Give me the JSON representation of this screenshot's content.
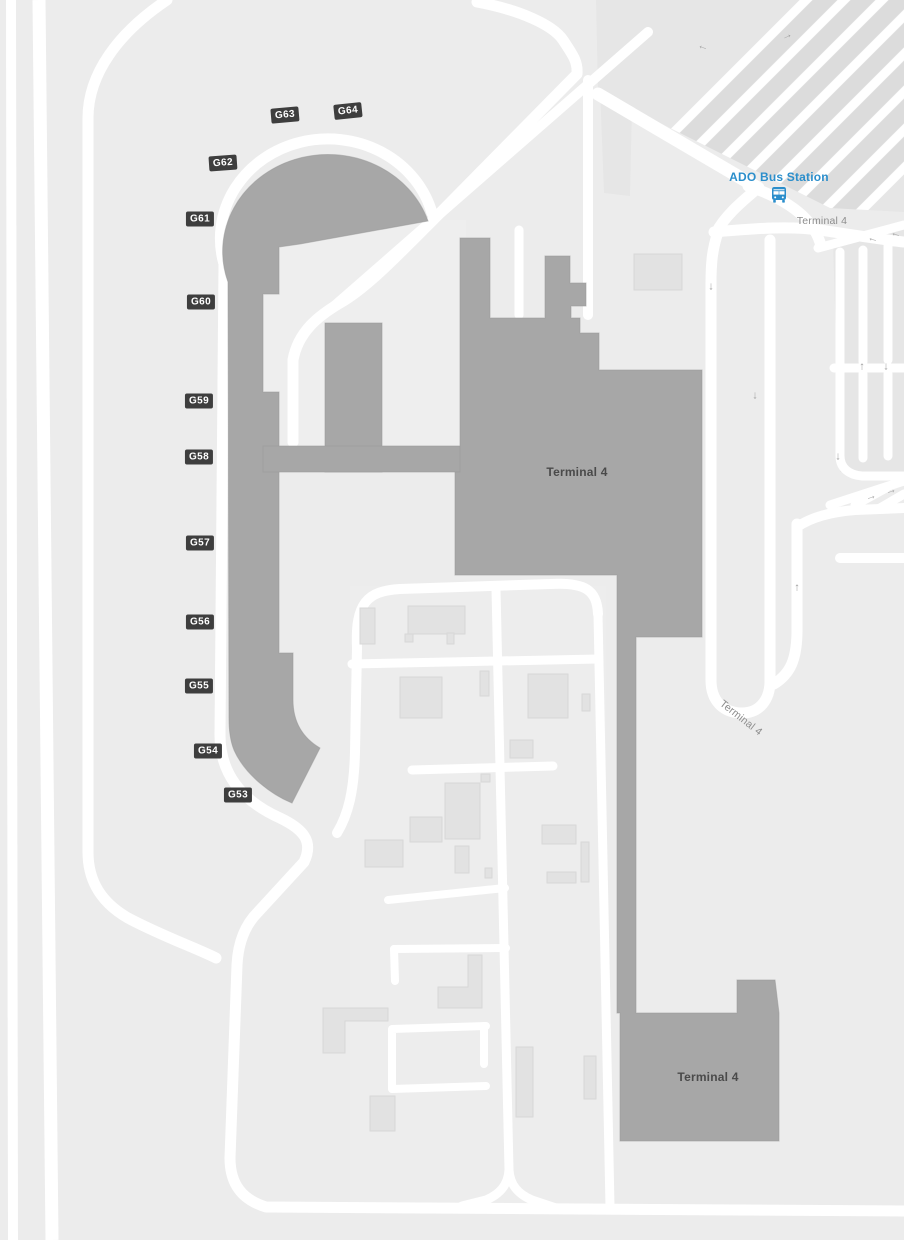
{
  "map_title": "Terminal 4 airport map",
  "colors": {
    "bg": "#ececec",
    "road": "#ffffff",
    "terminal": "#a7a7a7",
    "terminal_edge": "#999999",
    "building": "#e2e2e2",
    "building_edge": "#d7d7d7",
    "badge_bg": "#3e3e3e",
    "badge_text": "#ffffff",
    "blue": "#2b8ecb",
    "label_dark": "#4a4a4a",
    "label_gray": "#8d8d8d",
    "arrow": "#a2a2a2",
    "lane": "#dcdcdc",
    "parking_base": "#e6e6e6",
    "apron": "#f0f0f0"
  },
  "labels": [
    {
      "name": "terminal-label-main",
      "text": "Terminal 4",
      "x": 577,
      "y": 472,
      "rot": 0,
      "cls": "",
      "interactable": false
    },
    {
      "name": "terminal-label-south",
      "text": "Terminal 4",
      "x": 708,
      "y": 1077,
      "rot": 0,
      "cls": "",
      "interactable": false
    },
    {
      "name": "road-label-terminal4-top",
      "text": "Terminal 4",
      "x": 822,
      "y": 221,
      "rot": 0,
      "cls": "roadlbl",
      "interactable": false
    },
    {
      "name": "road-label-terminal4-curve",
      "text": "Terminal 4",
      "x": 741,
      "y": 718,
      "rot": 38,
      "cls": "roadlbl",
      "interactable": false
    },
    {
      "name": "ado-bus-station-label",
      "text": "ADO Bus Station",
      "x": 779,
      "y": 177,
      "rot": 0,
      "cls": "blue",
      "interactable": true
    }
  ],
  "gates": [
    {
      "label": "G64",
      "x": 348,
      "y": 111,
      "rot": -6
    },
    {
      "label": "G63",
      "x": 285,
      "y": 115,
      "rot": -5
    },
    {
      "label": "G62",
      "x": 223,
      "y": 163,
      "rot": -4
    },
    {
      "label": "G61",
      "x": 200,
      "y": 219,
      "rot": 0
    },
    {
      "label": "G60",
      "x": 201,
      "y": 302,
      "rot": 0
    },
    {
      "label": "G59",
      "x": 199,
      "y": 401,
      "rot": 0
    },
    {
      "label": "G58",
      "x": 199,
      "y": 457,
      "rot": 0
    },
    {
      "label": "G57",
      "x": 200,
      "y": 543,
      "rot": 0
    },
    {
      "label": "G56",
      "x": 200,
      "y": 622,
      "rot": 0
    },
    {
      "label": "G55",
      "x": 199,
      "y": 686,
      "rot": 0
    },
    {
      "label": "G54",
      "x": 208,
      "y": 751,
      "rot": 0
    },
    {
      "label": "G53",
      "x": 238,
      "y": 795,
      "rot": 0
    }
  ],
  "arrows": [
    {
      "name": "left-arrow",
      "glyph": "←",
      "x": 703,
      "y": 47,
      "rot": 18
    },
    {
      "name": "up-right-arrow",
      "glyph": "→",
      "x": 787,
      "y": 36,
      "rot": -25
    },
    {
      "name": "down-arrow",
      "glyph": "↓",
      "x": 711,
      "y": 287,
      "rot": 0
    },
    {
      "name": "down-arrow",
      "glyph": "↓",
      "x": 755,
      "y": 396,
      "rot": 0
    },
    {
      "name": "up-arrow",
      "glyph": "↑",
      "x": 862,
      "y": 367,
      "rot": 0
    },
    {
      "name": "down-arrow",
      "glyph": "↓",
      "x": 886,
      "y": 367,
      "rot": 0
    },
    {
      "name": "down-arrow",
      "glyph": "↓",
      "x": 838,
      "y": 457,
      "rot": 0
    },
    {
      "name": "up-arrow",
      "glyph": "↑",
      "x": 797,
      "y": 588,
      "rot": 0
    },
    {
      "name": "left-arrow",
      "glyph": "←",
      "x": 873,
      "y": 239,
      "rot": 15
    },
    {
      "name": "left-arrow",
      "glyph": "←",
      "x": 896,
      "y": 234,
      "rot": 15
    },
    {
      "name": "right-arrow",
      "glyph": "→",
      "x": 871,
      "y": 497,
      "rot": -16
    },
    {
      "name": "right-arrow",
      "glyph": "→",
      "x": 891,
      "y": 491,
      "rot": -16
    }
  ],
  "poi": {
    "bus_station": {
      "label": "ADO Bus Station",
      "icon": "bus-icon"
    }
  }
}
